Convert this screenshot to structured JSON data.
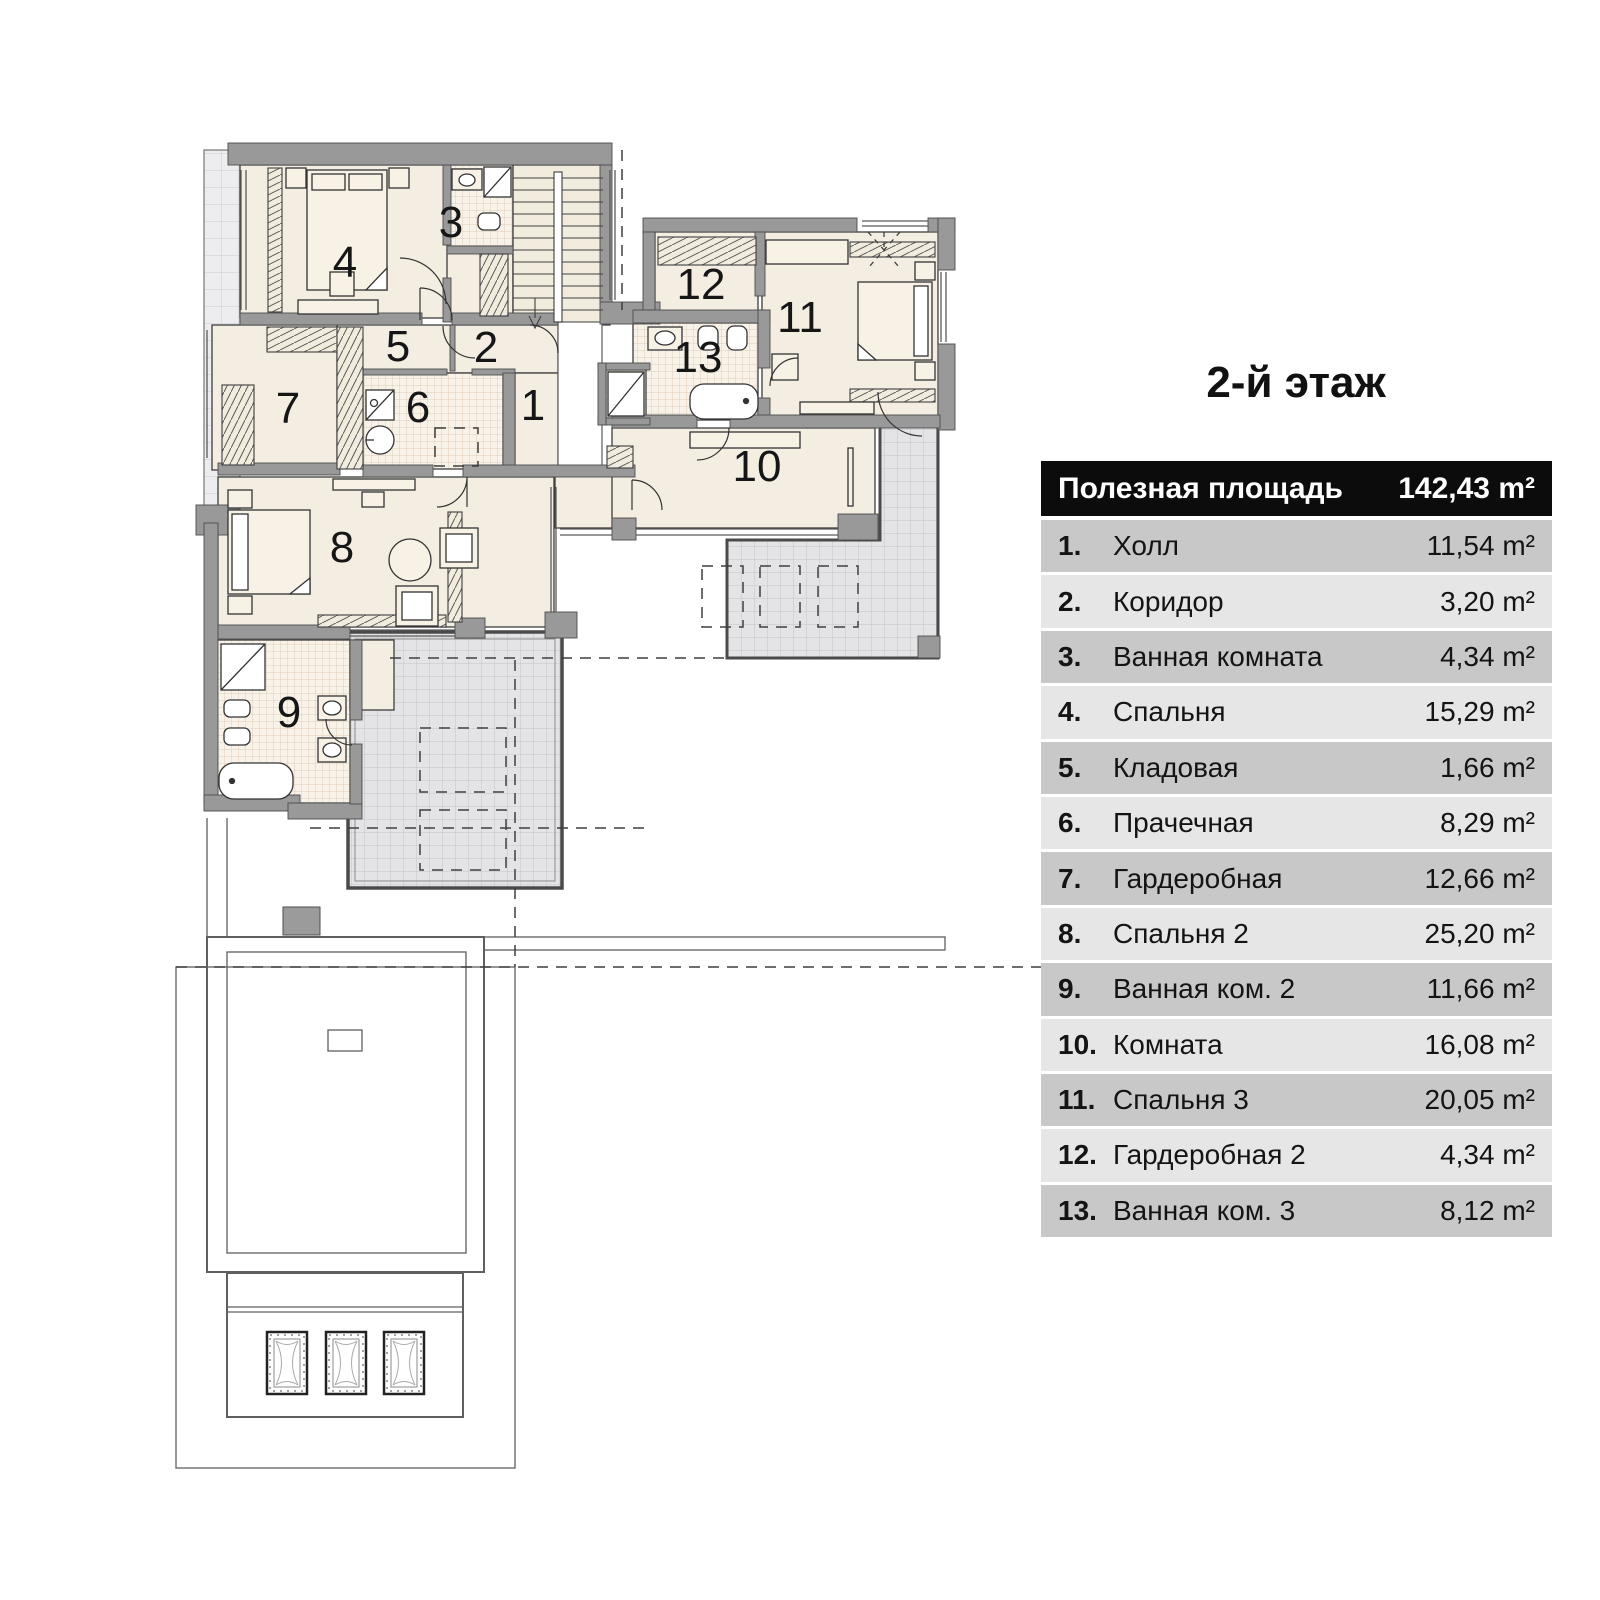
{
  "title": "2-й этаж",
  "legend": {
    "header": {
      "label": "Полезная площадь",
      "value": "142,43 m²"
    },
    "rows": [
      {
        "num": "1.",
        "name": "Холл",
        "value": "11,54 m²"
      },
      {
        "num": "2.",
        "name": "Коридор",
        "value": "3,20 m²"
      },
      {
        "num": "3.",
        "name": "Ванная комната",
        "value": "4,34 m²"
      },
      {
        "num": "4.",
        "name": "Спальня",
        "value": "15,29 m²"
      },
      {
        "num": "5.",
        "name": "Кладовая",
        "value": "1,66 m²"
      },
      {
        "num": "6.",
        "name": "Прачечная",
        "value": "8,29 m²"
      },
      {
        "num": "7.",
        "name": "Гардеробная",
        "value": "12,66 m²"
      },
      {
        "num": "8.",
        "name": "Спальня 2",
        "value": "25,20 m²"
      },
      {
        "num": "9.",
        "name": "Ванная ком. 2",
        "value": "11,66 m²"
      },
      {
        "num": "10.",
        "name": "Комната",
        "value": "16,08 m²"
      },
      {
        "num": "11.",
        "name": "Спальня 3",
        "value": "20,05 m²"
      },
      {
        "num": "12.",
        "name": "Гардеробная 2",
        "value": "4,34 m²"
      },
      {
        "num": "13.",
        "name": "Ванная ком.  3",
        "value": "8,12 m²"
      }
    ]
  },
  "plan": {
    "room_numbers": [
      "1",
      "2",
      "3",
      "4",
      "5",
      "6",
      "7",
      "8",
      "9",
      "10",
      "11",
      "12",
      "13"
    ]
  },
  "colors": {
    "wall": "#999999",
    "room_floor": "#f4eee2",
    "tile_floor": "#f9f2e9",
    "terrace": "#e4e4e7",
    "legend_header_bg": "#0c0c0c",
    "legend_row_dark": "#c8c8c8",
    "legend_row_light": "#e6e6e6"
  }
}
